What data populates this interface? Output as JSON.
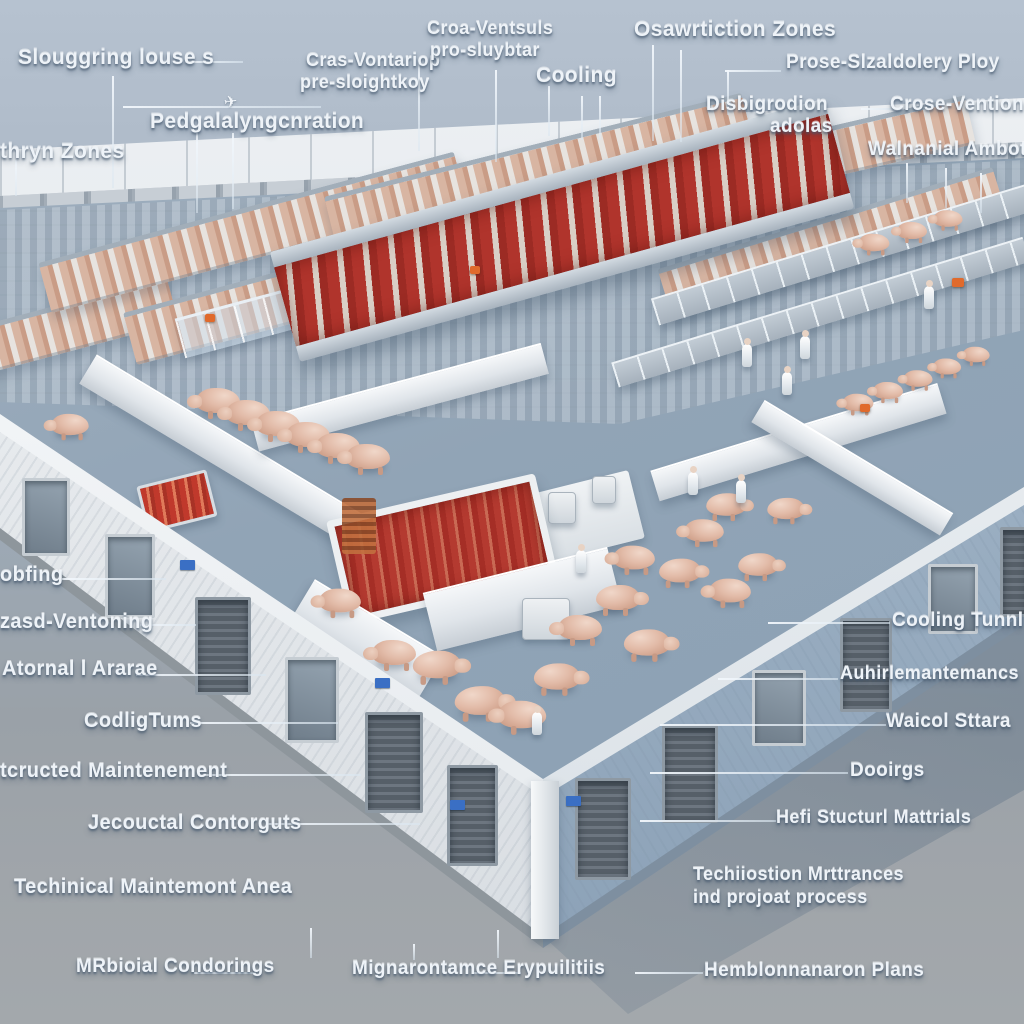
{
  "colors": {
    "sky_top": "#b6c2d0",
    "ground": "#9aa1a8",
    "floor": "#91a4b6",
    "left_wall": "#eff1f3",
    "right_wall": "#9db0c3",
    "meat_red": "#b43a30",
    "pig_pink": "#e2bba8",
    "steel": "#aeb9c4",
    "label_text": "#eef3f8",
    "shadow_blue": "#5f7a92",
    "sign_blue": "#3a6fc4",
    "accent_orange": "#e06a2c"
  },
  "annotations": [
    {
      "id": "slaughtering-houses",
      "text": "Slouggring louse s"
    },
    {
      "id": "thryn-zones",
      "text": "thryn Zones"
    },
    {
      "id": "pedgalaly",
      "text": "Pedgalalyngcnration"
    },
    {
      "id": "cras-vontariop-line1",
      "text": "Cras-Vontariop"
    },
    {
      "id": "cras-vontariop-line2",
      "text": "pre-sloightkoy"
    },
    {
      "id": "croa-ventsuls-line1",
      "text": "Croa-Ventsuls"
    },
    {
      "id": "croa-ventsuls-line2",
      "text": "pro-sluybtar"
    },
    {
      "id": "cooling-top",
      "text": "Cooling"
    },
    {
      "id": "osawrtiction-zones",
      "text": "Osawrtiction Zones"
    },
    {
      "id": "prose-ploy",
      "text": "Prose-Slzaldolery Ploy"
    },
    {
      "id": "disbigrodion-line1",
      "text": "Disbigrodion"
    },
    {
      "id": "disbigrodion-line2",
      "text": "adolas"
    },
    {
      "id": "crose-vention",
      "text": "Crose-Vention"
    },
    {
      "id": "walnanial-ambot",
      "text": "Walnanial Ambot"
    },
    {
      "id": "obfing",
      "text": "obfing"
    },
    {
      "id": "zasd-ventoning",
      "text": "zasd-Ventoning"
    },
    {
      "id": "atornal-ararae",
      "text": "Atornal l Ararae"
    },
    {
      "id": "codlig-tums",
      "text": "CodligTums"
    },
    {
      "id": "tcructed-maintenement",
      "text": "tcructed Maintenement"
    },
    {
      "id": "jecouctal-contorguts",
      "text": "Jecouctal Contorguts"
    },
    {
      "id": "techinical-maintemont-anea",
      "text": "Techinical Maintemont Anea"
    },
    {
      "id": "mrbioial-condorings",
      "text": "MRbioial Condorings"
    },
    {
      "id": "mignarontamce-erypuilitiis",
      "text": "Mignarontamce Erypuilitiis"
    },
    {
      "id": "hemblonnanaron-plans",
      "text": "Hemblonnanaron Plans"
    },
    {
      "id": "techiiostion-line1",
      "text": "Techiiostion Mrttrances"
    },
    {
      "id": "techiiostion-line2",
      "text": "ind projoat process"
    },
    {
      "id": "cooling-tunnl",
      "text": "Cooling Tunnl"
    },
    {
      "id": "auhirlemantemancs",
      "text": "Auhirlemantemancs"
    },
    {
      "id": "waicol-sttara",
      "text": "Waicol Sttara"
    },
    {
      "id": "dooirgs",
      "text": "Dooirgs"
    },
    {
      "id": "hefi-stucturl-mattrials",
      "text": "Hefi Stucturl Mattrials"
    }
  ]
}
